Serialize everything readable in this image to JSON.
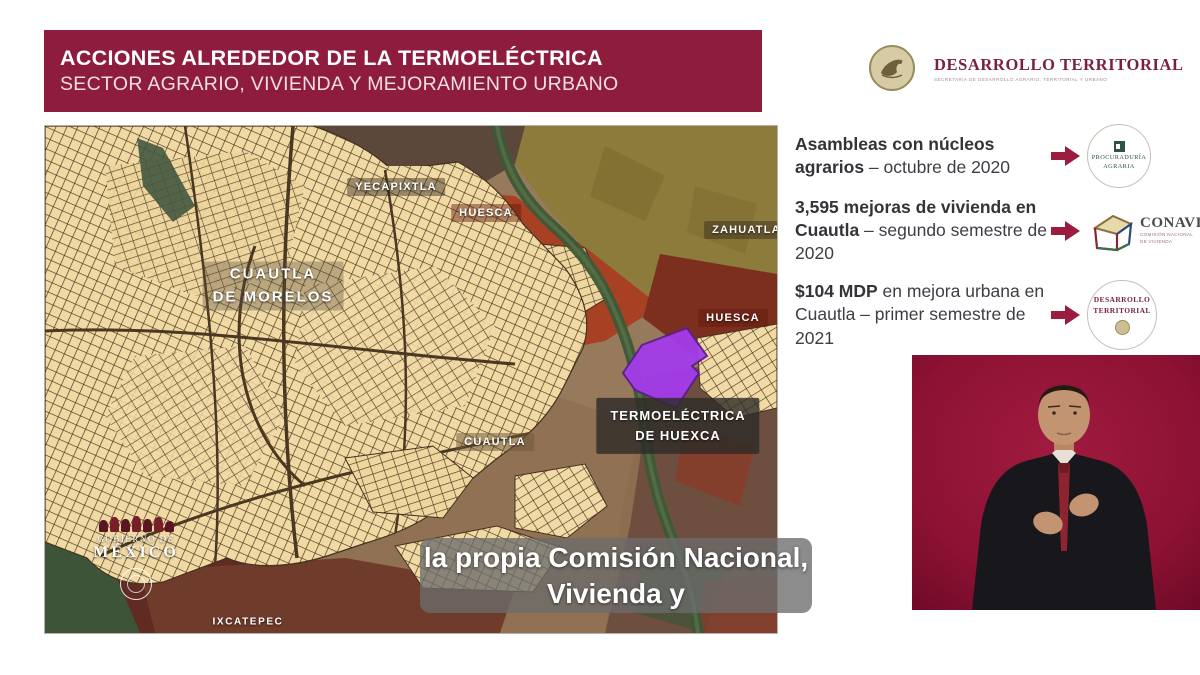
{
  "header": {
    "title": "ACCIONES ALREDEDOR DE LA TERMOELÉCTRICA",
    "subtitle": "SECTOR AGRARIO, VIVIENDA Y MEJORAMIENTO URBANO"
  },
  "brand": {
    "name": "DESARROLLO TERRITORIAL",
    "tagline": "SECRETARÍA DE DESARROLLO AGRARIO, TERRITORIAL Y URBANO"
  },
  "info_items": [
    {
      "bold": "Asambleas con núcleos agrarios",
      "text": " – octubre de 2020"
    },
    {
      "bold": "3,595 mejoras de vivienda en Cuautla",
      "text": " – segundo semestre de 2020"
    },
    {
      "bold": "$104 MDP",
      "text": " en mejora urbana en Cuautla – primer semestre de 2021"
    }
  ],
  "logos": {
    "procuraduria": {
      "line1": "PROCURADURÍA",
      "line2": "AGRARIA"
    },
    "conavi": {
      "name": "CONAVI",
      "sub1": "COMISIÓN NACIONAL",
      "sub2": "DE VIVIENDA"
    },
    "desarrollo": {
      "line1": "DESARROLLO",
      "line2": "TERRITORIAL"
    }
  },
  "map": {
    "labels": {
      "yecapixtla": "YECAPIXTLA",
      "huesca_north": "HUESCA",
      "zahuatlan": "ZAHUATLAN",
      "cuautla_morelos_1": "CUAUTLA",
      "cuautla_morelos_2": "DE MORELOS",
      "huesca_east": "HUESCA",
      "termo_1": "TERMOELÉCTRICA",
      "termo_2": "DE HUEXCA",
      "cuautla": "CUAUTLA",
      "ixcatepec": "IXCATEPEC"
    },
    "watermark": {
      "line1": "GOBIERNO DE",
      "line2": "MÉXICO"
    }
  },
  "caption": {
    "line1": "la propia Comisión Nacional,",
    "line2": "Vivienda y"
  },
  "colors": {
    "header_bg": "#8E1C3D",
    "arrow": "#9C1C40",
    "brand_text": "#7A1F3D",
    "site_purple": "#A33CEA",
    "interpreter_bg": "#8C1133"
  }
}
